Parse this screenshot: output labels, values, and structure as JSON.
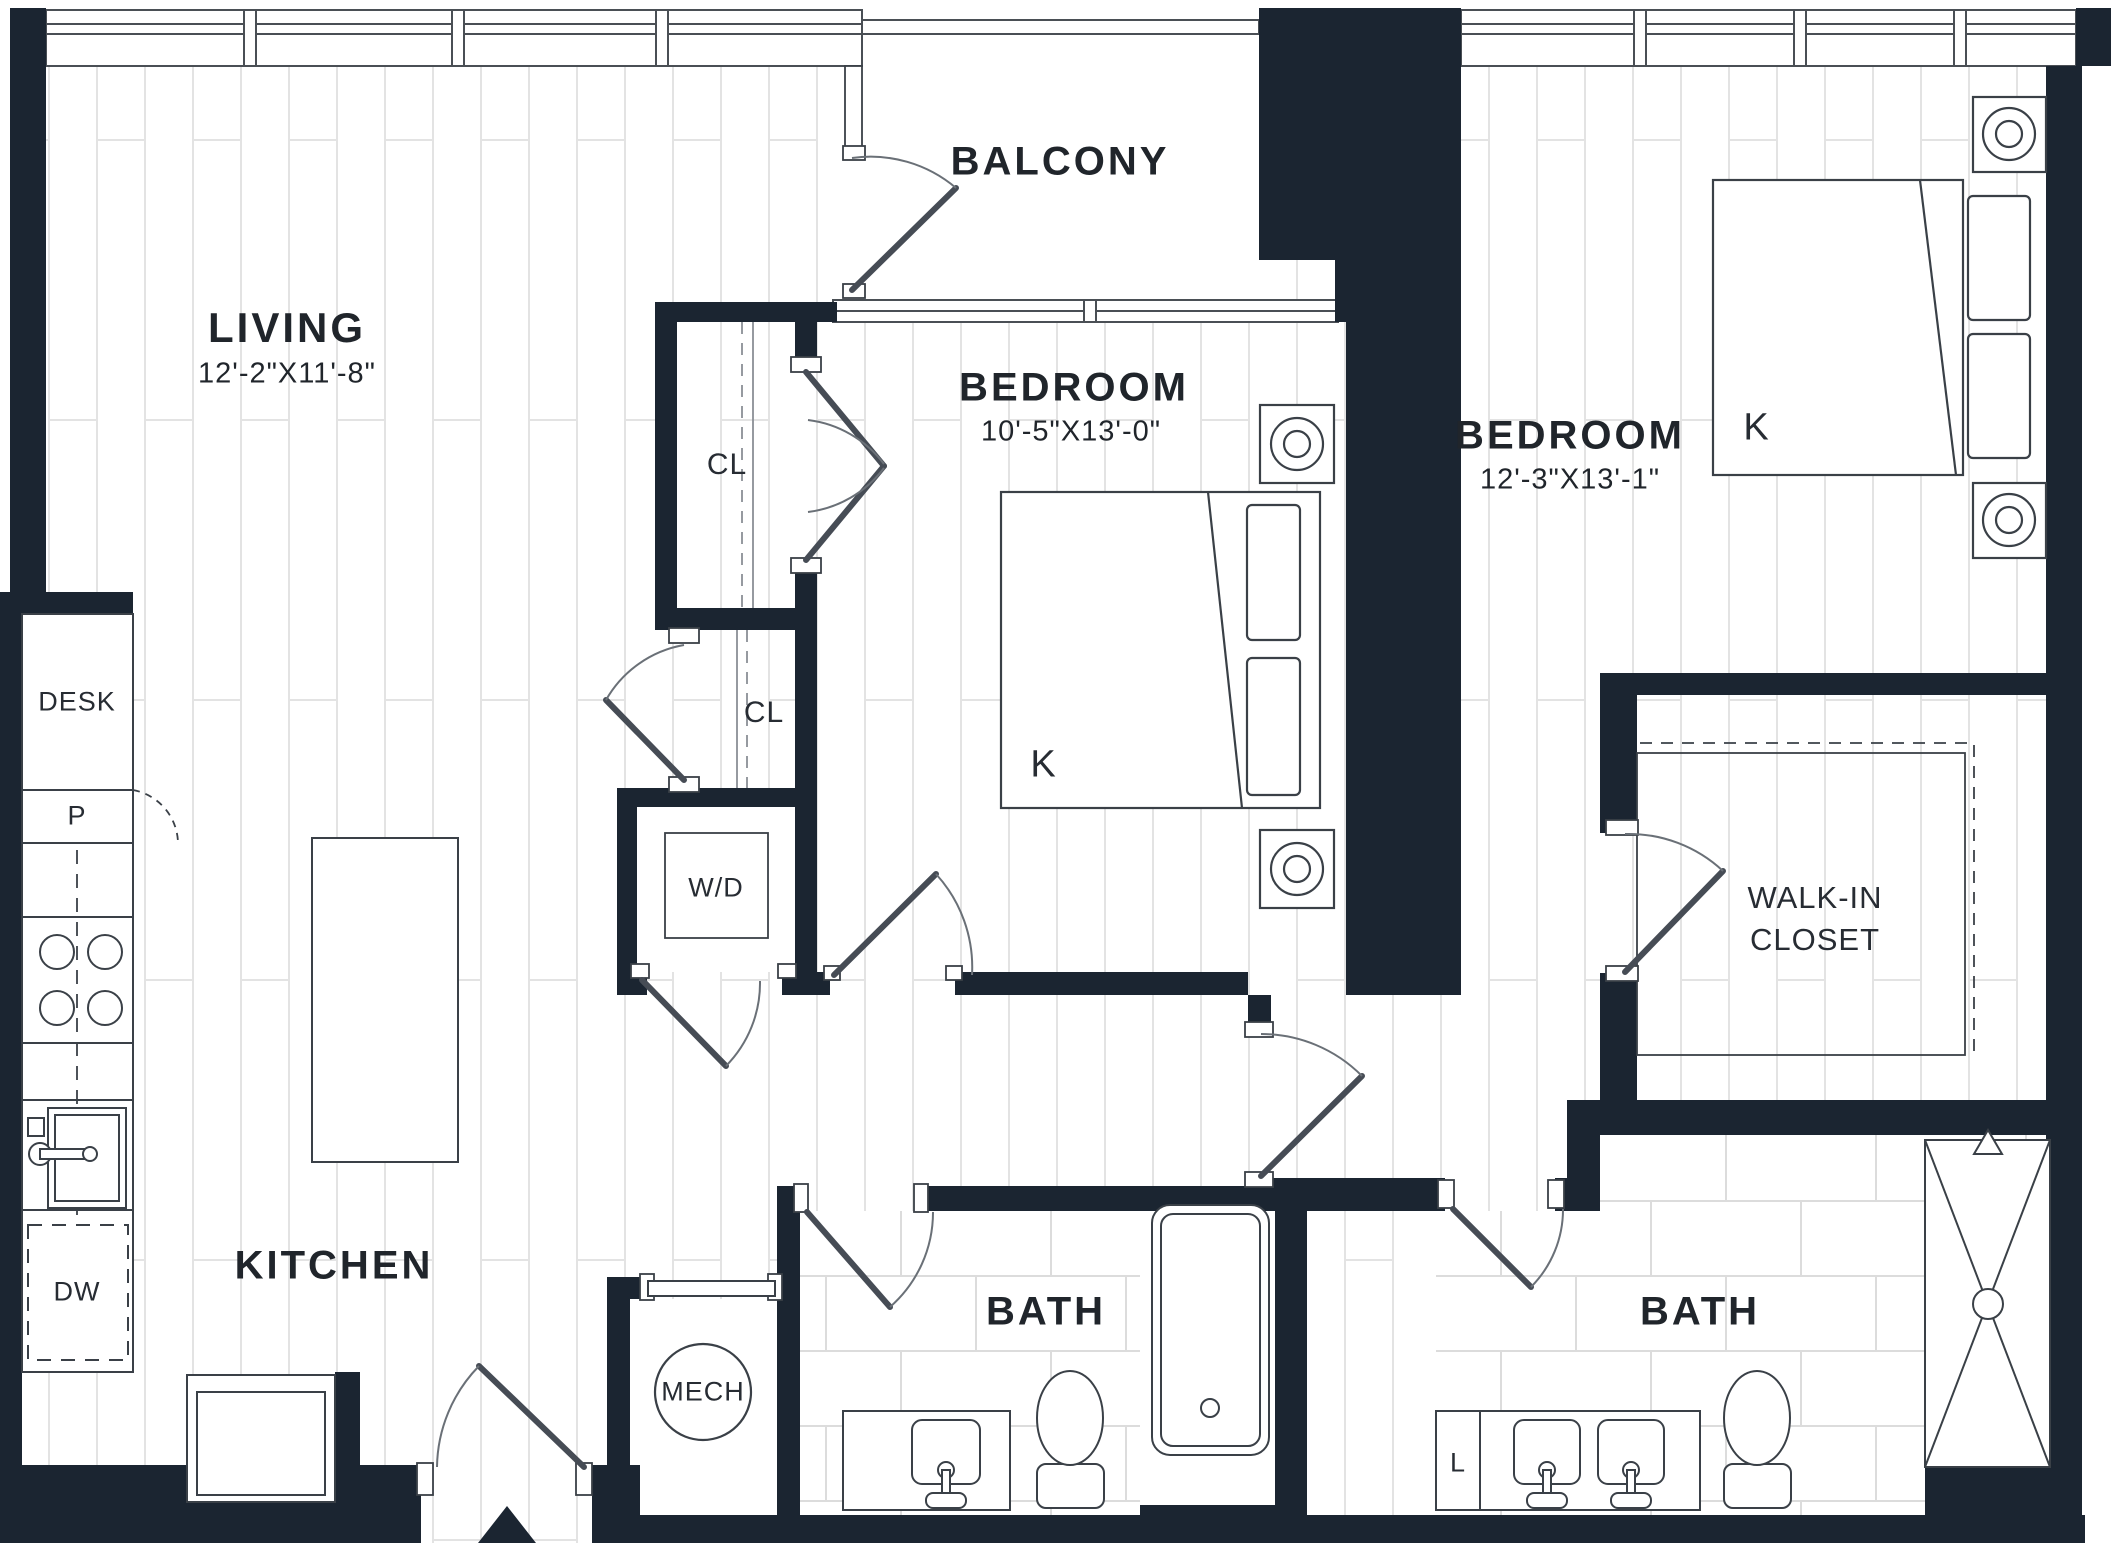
{
  "plan": {
    "type": "apartment-floor-plan",
    "colors": {
      "wall": "#1b2531",
      "fixture_line": "#3a4047",
      "plank_line": "#e3e3e3",
      "tile_line": "#dcdcdc",
      "text": "#20252b"
    },
    "rooms": {
      "living": {
        "name": "LIVING",
        "dims": "12'-2\"X11'-8\""
      },
      "balcony": {
        "name": "BALCONY"
      },
      "bedroom1": {
        "name": "BEDROOM",
        "dims": "10'-5\"X13'-0\"",
        "bed_label": "K"
      },
      "bedroom2": {
        "name": "BEDROOM",
        "dims": "12'-3\"X13'-1\"",
        "bed_label": "K"
      },
      "walkin": {
        "line1": "WALK-IN",
        "line2": "CLOSET"
      },
      "kitchen": {
        "name": "KITCHEN"
      },
      "bath1": {
        "name": "BATH"
      },
      "bath2": {
        "name": "BATH"
      },
      "mech": {
        "name": "MECH"
      },
      "closet1": {
        "name": "CL"
      },
      "closet2": {
        "name": "CL"
      },
      "laundry": {
        "name": "W/D"
      },
      "desk": {
        "name": "DESK"
      },
      "pantry": {
        "name": "P"
      },
      "dishwasher": {
        "name": "DW"
      },
      "linen": {
        "name": "L"
      }
    }
  }
}
